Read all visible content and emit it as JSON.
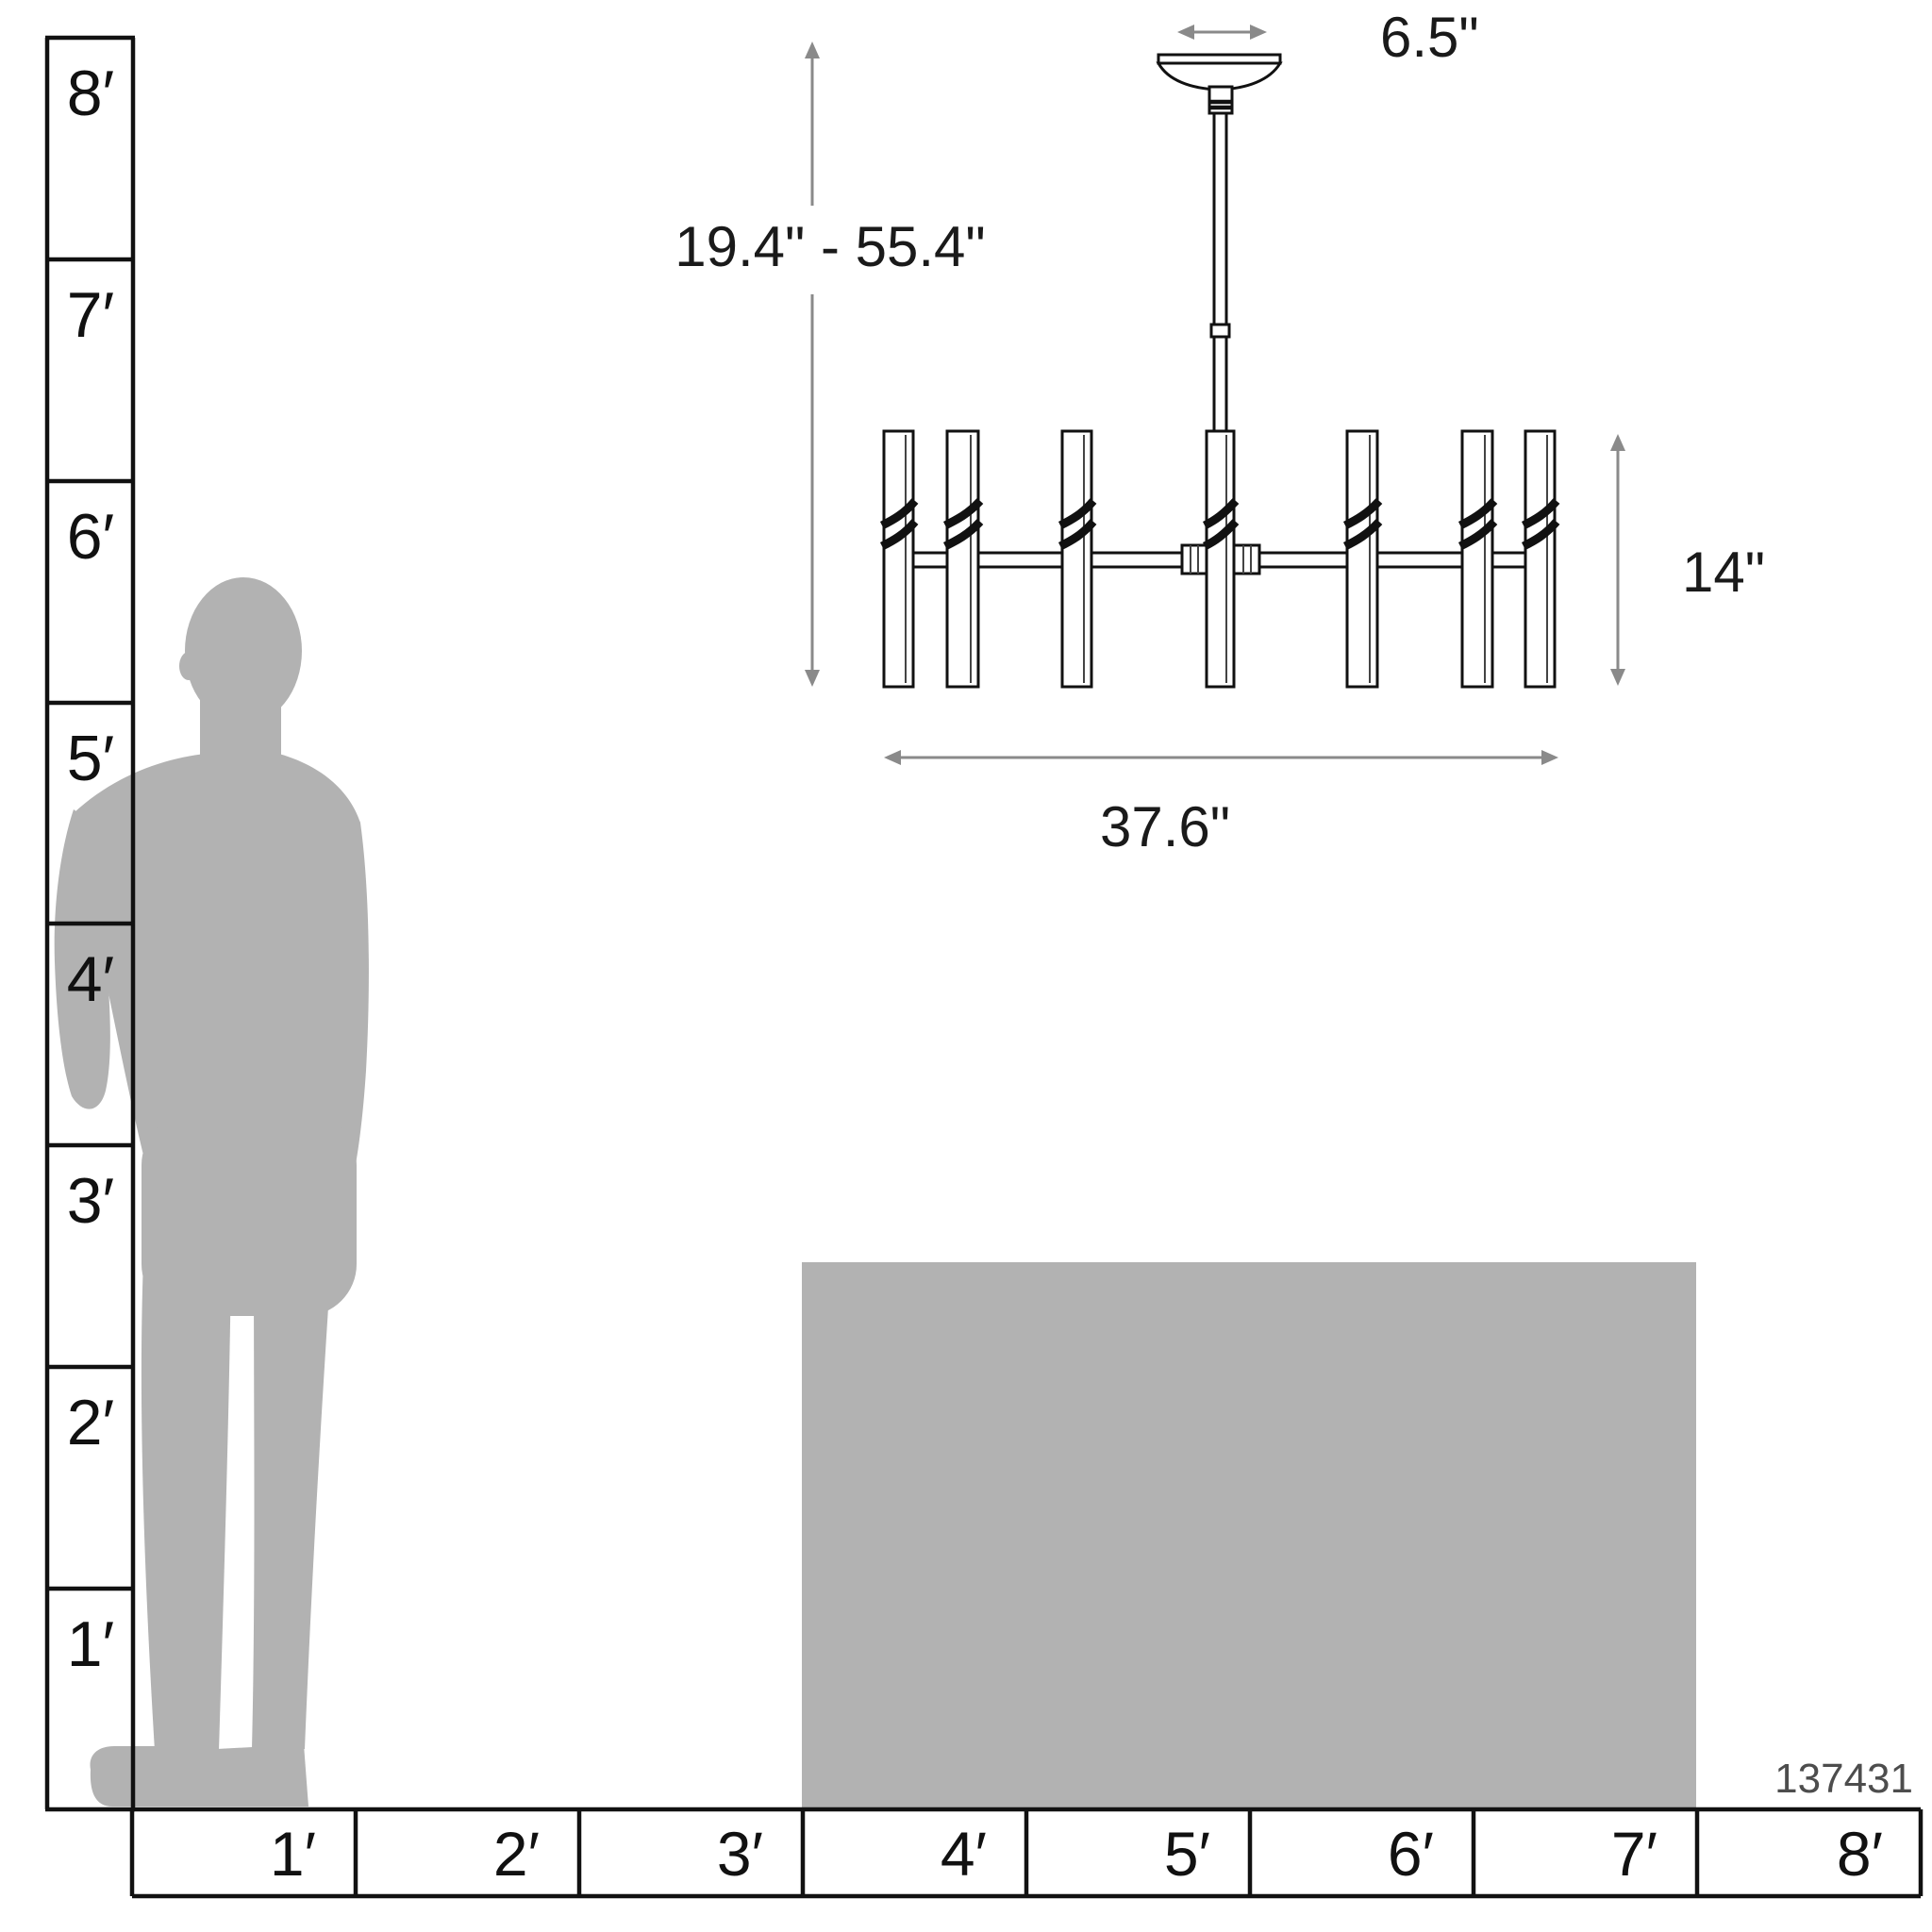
{
  "diagram_title": "chandelier-scale-dimension-diagram",
  "product_number": "137431",
  "dimensions": {
    "hang_range": "19.4\" - 55.4\"",
    "canopy_width": "6.5\"",
    "fixture_height": "14\"",
    "fixture_width": "37.6\""
  },
  "rulers": {
    "vertical": {
      "labels": {
        "0": "8′",
        "1": "7′",
        "2": "6′",
        "3": "5′",
        "4": "4′",
        "5": "3′",
        "6": "2′",
        "7": "1′"
      }
    },
    "horizontal": {
      "labels": {
        "0": "1′",
        "1": "2′",
        "2": "3′",
        "3": "4′",
        "4": "5′",
        "5": "6′",
        "6": "7′",
        "7": "8′"
      }
    }
  },
  "colors": {
    "silhouette_gray": "#b2b2b2",
    "drawing_line": "#111111",
    "dimension_gray": "#8a8a8a",
    "product_number_text": "#4d4d4d",
    "background": "#ffffff"
  }
}
